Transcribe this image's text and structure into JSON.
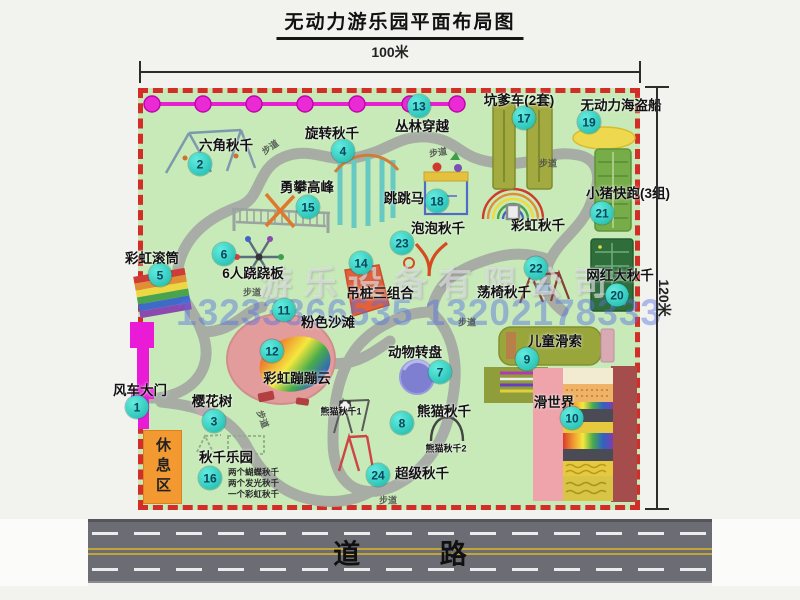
{
  "title": "无动力游乐园平面布局图",
  "dim_top": "100米",
  "dim_right": "120米",
  "road_label": "道 路",
  "rest_area_label": "休息区",
  "watermark_company": "游乐设备有限公司",
  "watermark_phone": "13233866535 13202178333",
  "colors": {
    "park_green": "#c7eab8",
    "border_red": "#d32d28",
    "badge_teal": "#19b7ab",
    "magenta": "#ea1bd7",
    "rest_orange": "#f29a31",
    "road_gray": "#6c6c74"
  },
  "map": {
    "path_label_text": "步道",
    "items": [
      {
        "num": 1,
        "label": "风车大门",
        "lx": 140,
        "ly": 389,
        "bx": 137,
        "by": 407
      },
      {
        "num": 2,
        "label": "六角秋千",
        "lx": 226,
        "ly": 144,
        "bx": 200,
        "by": 164
      },
      {
        "num": 3,
        "label": "樱花树",
        "lx": 212,
        "ly": 400,
        "bx": 214,
        "by": 421
      },
      {
        "num": 4,
        "label": "旋转秋千",
        "lx": 332,
        "ly": 132,
        "bx": 343,
        "by": 151
      },
      {
        "num": 5,
        "label": "彩虹滚筒",
        "lx": 152,
        "ly": 257,
        "bx": 160,
        "by": 275
      },
      {
        "num": 6,
        "label": "6人跷跷板",
        "lx": 253,
        "ly": 272,
        "bx": 224,
        "by": 254
      },
      {
        "num": 7,
        "label": "动物转盘",
        "lx": 415,
        "ly": 351,
        "bx": 440,
        "by": 372
      },
      {
        "num": 8,
        "label": "熊猫秋千",
        "lx": 444,
        "ly": 410,
        "bx": 402,
        "by": 423
      },
      {
        "num": 9,
        "label": "儿童滑索",
        "lx": 555,
        "ly": 340,
        "bx": 527,
        "by": 359
      },
      {
        "num": 10,
        "label": "滑世界",
        "lx": 554,
        "ly": 401,
        "bx": 572,
        "by": 418
      },
      {
        "num": 11,
        "label": "粉色沙滩",
        "lx": 328,
        "ly": 321,
        "bx": 284,
        "by": 310
      },
      {
        "num": 12,
        "label": "彩虹蹦蹦云",
        "lx": 297,
        "ly": 377,
        "bx": 272,
        "by": 351
      },
      {
        "num": 13,
        "label": "丛林穿越",
        "lx": 422,
        "ly": 125,
        "bx": 419,
        "by": 106
      },
      {
        "num": 14,
        "label": "吊桩三组合",
        "lx": 380,
        "ly": 292,
        "bx": 361,
        "by": 263
      },
      {
        "num": 15,
        "label": "勇攀高峰",
        "lx": 307,
        "ly": 186,
        "bx": 308,
        "by": 207
      },
      {
        "num": 16,
        "label": "秋千乐园",
        "lx": 226,
        "ly": 456,
        "bx": 210,
        "by": 478
      },
      {
        "num": 17,
        "label": "坑爹车(2套)",
        "lx": 519,
        "ly": 99,
        "bx": 524,
        "by": 118
      },
      {
        "num": 18,
        "label": "跳跳马",
        "lx": 404,
        "ly": 197,
        "bx": 437,
        "by": 201
      },
      {
        "num": 19,
        "label": "无动力海盗船",
        "lx": 621,
        "ly": 104,
        "bx": 589,
        "by": 122
      },
      {
        "num": 20,
        "label": "网红大秋千",
        "lx": 620,
        "ly": 274,
        "bx": 617,
        "by": 295
      },
      {
        "num": 21,
        "label": "小猪快跑(3组)",
        "lx": 628,
        "ly": 192,
        "bx": 602,
        "by": 213
      },
      {
        "num": 22,
        "label": "荡椅秋千",
        "lx": 504,
        "ly": 291,
        "bx": 536,
        "by": 268
      },
      {
        "num": 23,
        "label": "泡泡秋千",
        "lx": 438,
        "ly": 227,
        "bx": 402,
        "by": 243
      },
      {
        "num": 24,
        "label": "超级秋千",
        "lx": 422,
        "ly": 472,
        "bx": 378,
        "by": 475
      }
    ],
    "extra_labels": [
      {
        "text": "彩虹秋千",
        "x": 538,
        "y": 224,
        "size": 13.5
      },
      {
        "text": "熊猫秋千1",
        "x": 341,
        "y": 411,
        "size": 9
      },
      {
        "text": "熊猫秋千2",
        "x": 446,
        "y": 448,
        "size": 9
      }
    ],
    "swing_park_notes": [
      "两个蝴蝶秋千",
      "两个发光秋千",
      "一个彩虹秋千"
    ],
    "path_labels": [
      {
        "x": 270,
        "y": 147,
        "r": -35
      },
      {
        "x": 438,
        "y": 152,
        "r": -8
      },
      {
        "x": 548,
        "y": 163,
        "r": 0
      },
      {
        "x": 252,
        "y": 292,
        "r": 0
      },
      {
        "x": 467,
        "y": 322,
        "r": 0
      },
      {
        "x": 263,
        "y": 419,
        "r": 70
      },
      {
        "x": 388,
        "y": 500,
        "r": 0
      }
    ]
  }
}
